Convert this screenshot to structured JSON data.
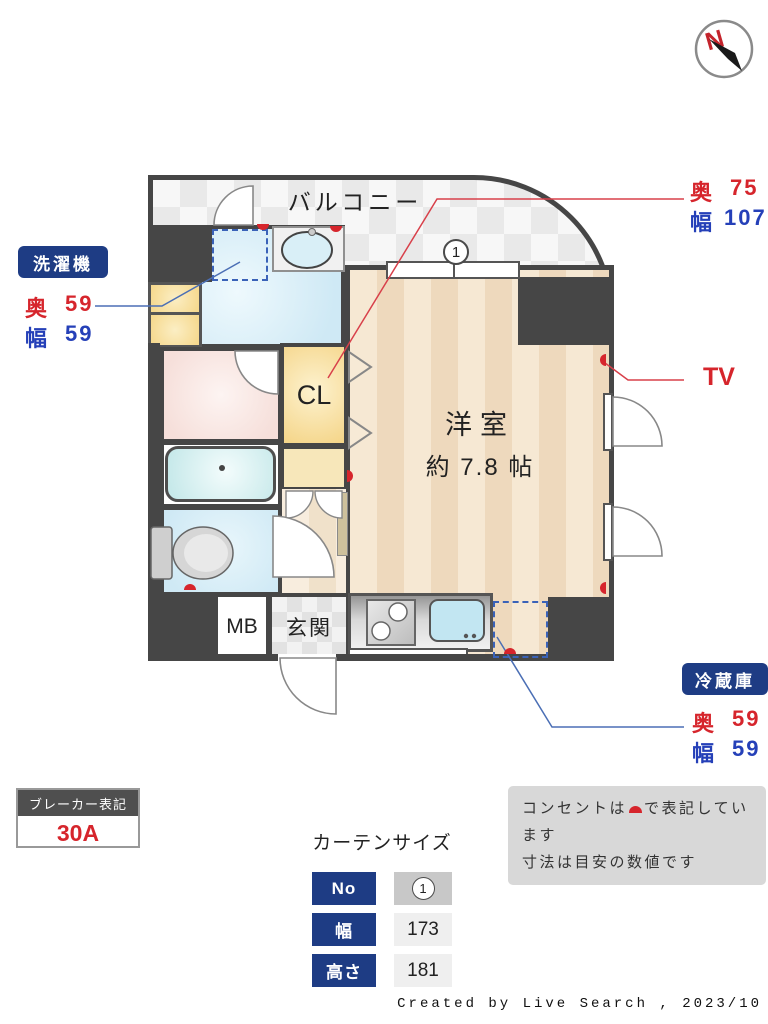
{
  "compass": {
    "label": "N"
  },
  "plan": {
    "balcony_label": "バルコニー",
    "room_label": "洋室",
    "room_size": "約 7.8 帖",
    "cl_label": "CL",
    "mb_label": "MB",
    "genkan_label": "玄関",
    "window_no": "1"
  },
  "labels": {
    "washer": {
      "title": "洗濯機",
      "rows": [
        {
          "k": "奥",
          "v": "59"
        },
        {
          "k": "幅",
          "v": "59"
        }
      ]
    },
    "closet_dim": {
      "rows": [
        {
          "k": "奥",
          "v": "75"
        },
        {
          "k": "幅",
          "v": "107"
        }
      ]
    },
    "tv": "TV",
    "fridge": {
      "title": "冷蔵庫",
      "rows": [
        {
          "k": "奥",
          "v": "59"
        },
        {
          "k": "幅",
          "v": "59"
        }
      ]
    },
    "breaker": {
      "title": "ブレーカー表記",
      "value": "30A"
    },
    "note_line1_pre": "コンセントは",
    "note_line1_post": "で表記しています",
    "note_line2": "寸法は目安の数値です"
  },
  "curtain": {
    "title": "カーテンサイズ",
    "rows": [
      {
        "label": "No",
        "value": "1",
        "circled": true
      },
      {
        "label": "幅",
        "value": "173"
      },
      {
        "label": "高さ",
        "value": "181"
      }
    ]
  },
  "credit": "Created by Live Search , 2023/10",
  "colors": {
    "wall": "#464646",
    "accent_red": "#d6252c",
    "accent_navy": "#1e3c84",
    "leader_blue": "#4b6fb5",
    "leader_red": "#d8404a"
  }
}
